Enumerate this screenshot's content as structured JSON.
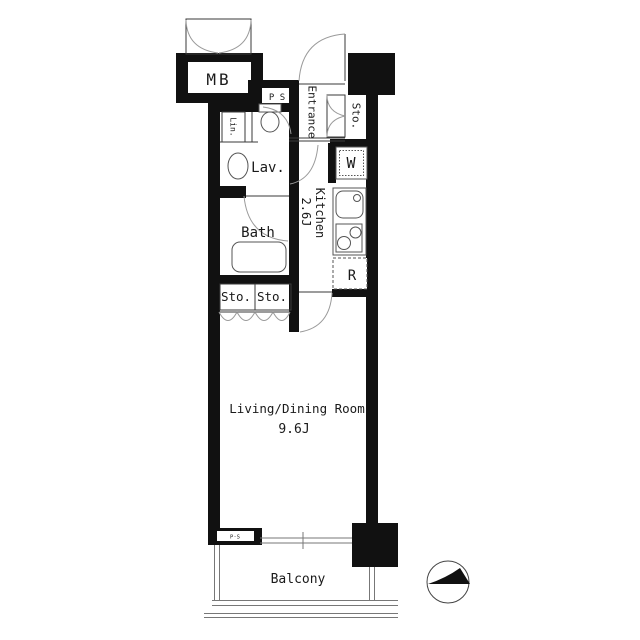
{
  "title": "apartment-floor-plan",
  "colors": {
    "background": "#ffffff",
    "wall": "#111111",
    "thin_line": "#3a3a3a",
    "door_arc": "#9a9a9a",
    "text": "#1a1a1a"
  },
  "floorplan": {
    "mb_label": "MB",
    "ps_top_label": "P S",
    "entrance_label": "Entrance",
    "entrance_storage_label": "Sto.",
    "linen_label": "Lin.",
    "lavatory_label": "Lav.",
    "washer_label": "W",
    "kitchen_label": "Kitchen",
    "kitchen_size": "2.6J",
    "bath_label": "Bath",
    "fridge_label": "R",
    "storage_left_label": "Sto.",
    "storage_right_label": "Sto.",
    "living_label": "Living/Dining Room",
    "living_size": "9.6J",
    "ps_bottom_label": "P·S",
    "balcony_label": "Balcony"
  }
}
